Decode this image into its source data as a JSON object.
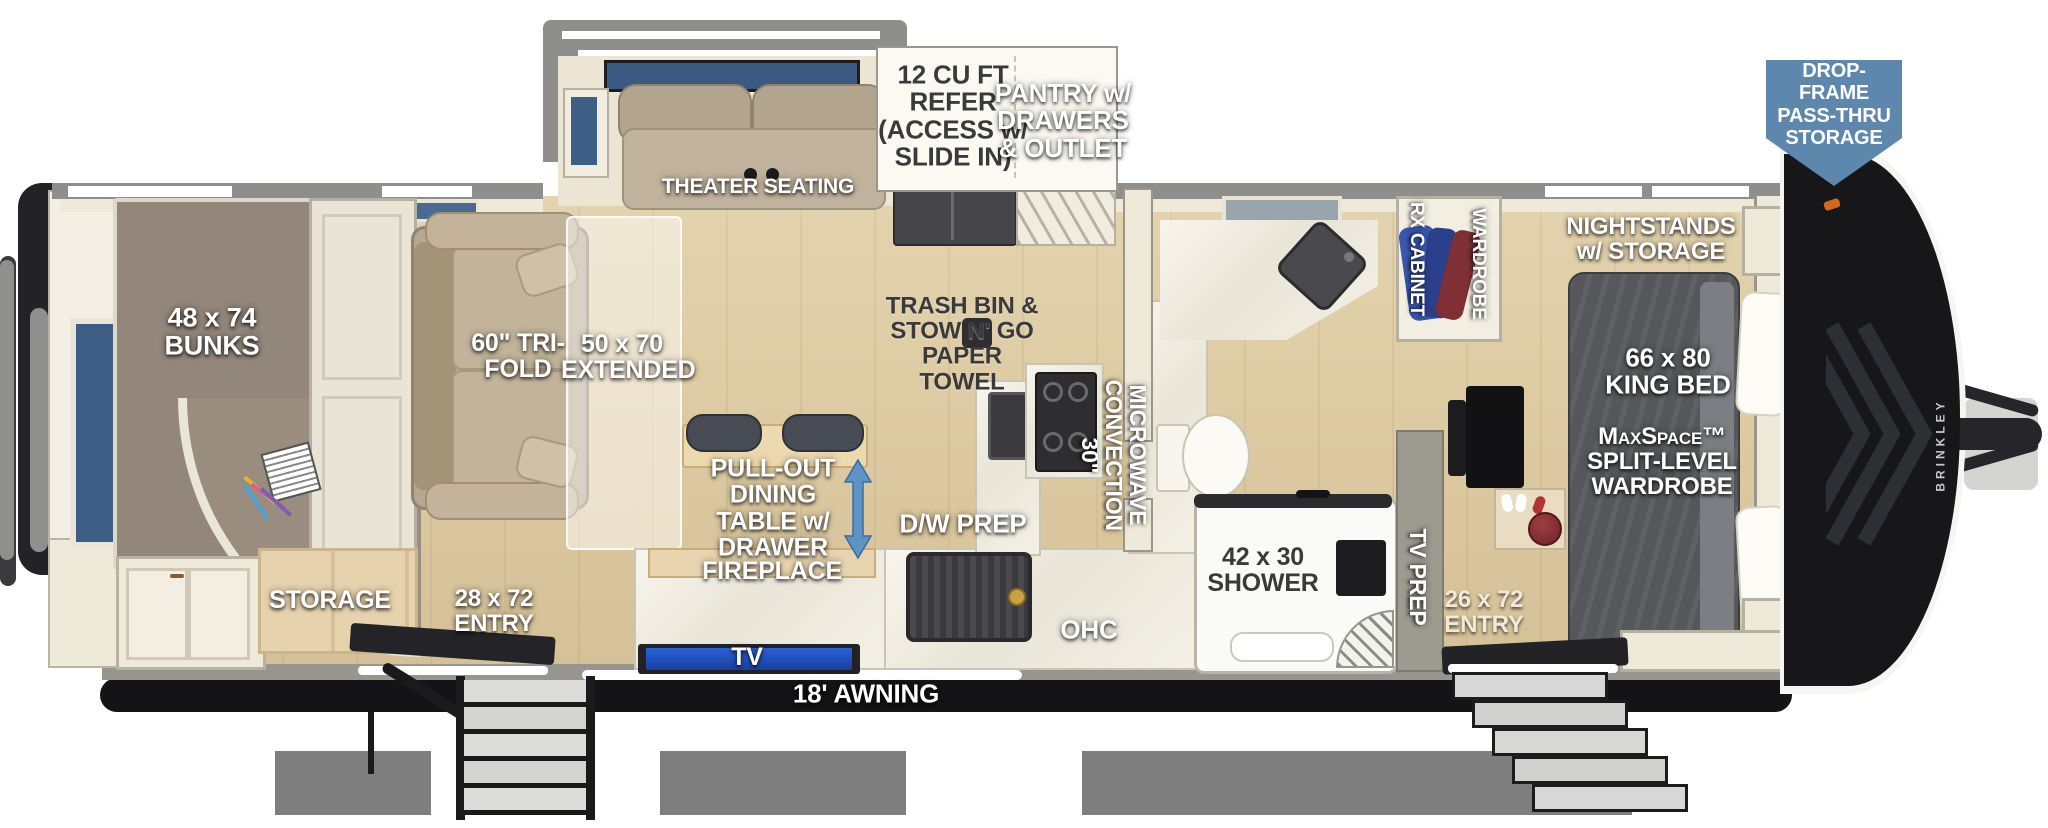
{
  "badge": {
    "text": "DROP-FRAME PASS-THRU STORAGE",
    "bg_color": "#5d87ad",
    "text_color": "#ffffff"
  },
  "labels": {
    "theater_seating": "THEATER SEATING",
    "refer": "12 CU FT REFER (ACCESS w/ SLIDE IN)",
    "pantry": "PANTRY w/ DRAWERS & OUTLET",
    "bunks": "48 x 74 BUNKS",
    "tri_fold": "60\" TRI-FOLD",
    "extended": "50 x 70 EXTENDED",
    "trash_bin": "TRASH BIN & STOW N' GO PAPER TOWEL",
    "dining_table": "PULL-OUT DINING TABLE w/ DRAWER",
    "fireplace": "FIREPLACE",
    "dw_prep": "D/W PREP",
    "microwave": "30\" CONVECTION MICROWAVE",
    "ohc": "OHC",
    "tv": "TV",
    "awning": "18'  AWNING",
    "storage": "STORAGE",
    "entry_left": "28 x 72 ENTRY",
    "entry_right": "26 x 72 ENTRY",
    "shower": "42 x 30 SHOWER",
    "tv_prep": "TV PREP",
    "rx_cabinet": "RX CABINET",
    "wardrobe": "WARDROBE",
    "nightstands": "NIGHTSTANDS w/ STORAGE",
    "king_bed": "66 x 80 KING BED",
    "maxspace": "MaxSpace™ SPLIT-LEVEL WARDROBE",
    "brand": "BRINKLEY"
  },
  "colors": {
    "badge_blue": "#5d87ad",
    "arrow_blue": "#5e93c6",
    "window_blue": "#3f5e85",
    "tv_screen_blue": "#2a62d8"
  }
}
